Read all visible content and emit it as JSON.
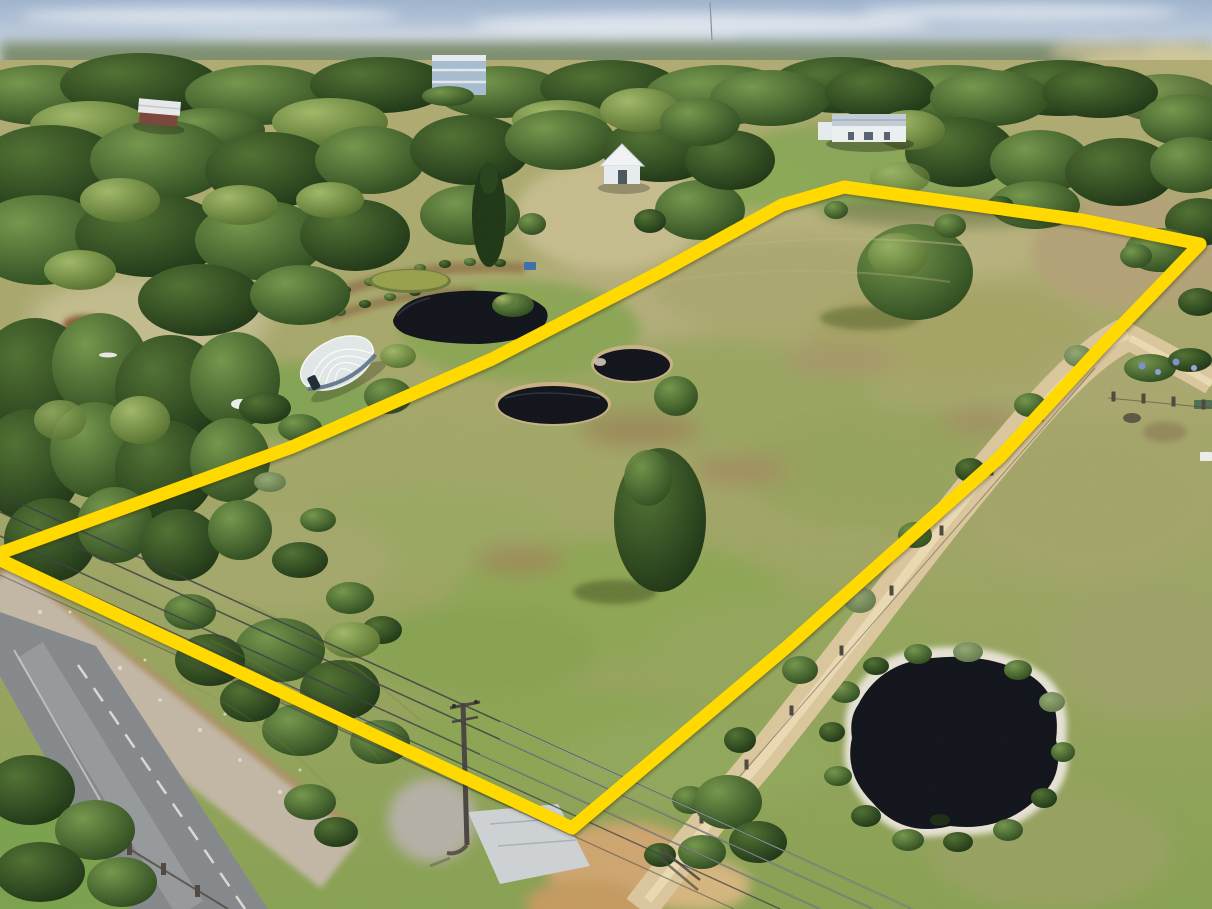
{
  "meta": {
    "type": "aerial-drone-photograph",
    "subject": "rural acreage property outlined with a yellow boundary highlight",
    "image_width": 1212,
    "image_height": 909,
    "visible_text": "none"
  },
  "boundary": {
    "label": "property-boundary-highlight",
    "color": "#ffd900",
    "stroke_width": 13,
    "points": "-8,556 292,447 492,359 662,271 782,205 844,187 1082,220 1200,244 1102,346 1000,457 788,646 572,828"
  },
  "palette": {
    "sky_top": "#9fb4ce",
    "sky_horizon": "#e2e8ef",
    "haze_treeline": "#7d8e6e",
    "far_paddock": "#cfc89b",
    "ground_top": "#b0ab72",
    "ground_mid": "#a0a565",
    "ground_bottom": "#87a150",
    "lawn_green": "#79a24b",
    "water_dark": "#0e1218",
    "pond_algae": "#97a049",
    "pond_rim_tan": "#c7b185",
    "sand_rim_white": "#e7e2d4",
    "road_asphalt": "#85888b",
    "road_wear": "#9a9da0",
    "road_line_white": "#e9e9e5",
    "gravel_verge": "#c3b7a5",
    "verge_dirt": "#b08f66",
    "dirt_track": "#dbc79c",
    "dirt_track_centre": "#ecdcb6",
    "concrete": "#ced2d4",
    "sand_patch": "#cfa56e",
    "greenhouse_glazing": "#e8eef2",
    "greenhouse_base": "#5a6f85",
    "house_walls": "#eef1f2",
    "house_roof": "#c3cdd6",
    "cottage_wall_red": "#7a4438",
    "blue_building": "#a7bdd0",
    "wire": "#3b3e42",
    "pole": "#4a4440",
    "fence": "#4e463c"
  },
  "features": [
    {
      "name": "bushland-canopy",
      "kind": "vegetation"
    },
    {
      "name": "main-dam-with-island",
      "kind": "water"
    },
    {
      "name": "algae-pond",
      "kind": "water"
    },
    {
      "name": "sinkhole-dam",
      "kind": "water"
    },
    {
      "name": "oval-dam",
      "kind": "water"
    },
    {
      "name": "south-east-dam",
      "kind": "water"
    },
    {
      "name": "greenhouse-polytunnel",
      "kind": "structure"
    },
    {
      "name": "homestead",
      "kind": "structure"
    },
    {
      "name": "gabled-cottage",
      "kind": "structure"
    },
    {
      "name": "left-cottage",
      "kind": "structure"
    },
    {
      "name": "blue-two-storey-house",
      "kind": "structure"
    },
    {
      "name": "sealed-road",
      "kind": "road"
    },
    {
      "name": "gravel-driveway",
      "kind": "road"
    },
    {
      "name": "concrete-crossover",
      "kind": "road"
    },
    {
      "name": "power-pole",
      "kind": "utility"
    },
    {
      "name": "power-lines",
      "kind": "utility"
    },
    {
      "name": "paddock-trees",
      "kind": "vegetation"
    },
    {
      "name": "boundary-highlight",
      "kind": "annotation"
    }
  ]
}
